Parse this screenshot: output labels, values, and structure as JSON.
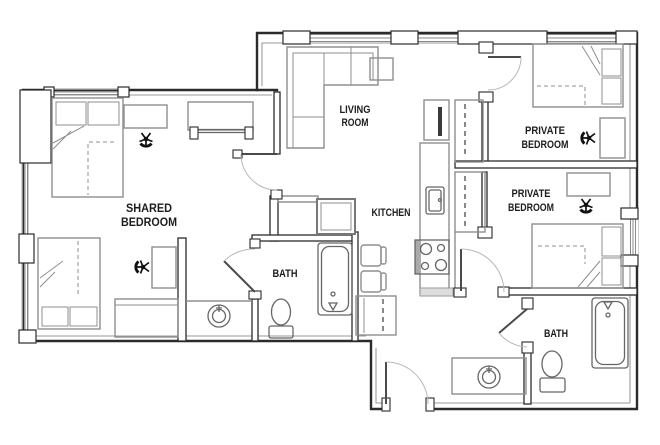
{
  "title": "Apartment floor plan",
  "colors": {
    "wall": "#2b2b2b",
    "furniture": "#8f8f8f",
    "fixture": "#666666",
    "label": "#1d1d1d",
    "background": "#ffffff"
  },
  "rooms": {
    "shared_bedroom": {
      "line1": "SHARED",
      "line2": "BEDROOM"
    },
    "living_room": {
      "line1": "LIVING",
      "line2": "ROOM"
    },
    "kitchen": {
      "label": "KITCHEN"
    },
    "bath_1": {
      "label": "BATH"
    },
    "private_bedroom_1": {
      "line1": "PRIVATE",
      "line2": "BEDROOM"
    },
    "private_bedroom_2": {
      "line1": "PRIVATE",
      "line2": "BEDROOM"
    },
    "bath_2": {
      "label": "BATH"
    }
  }
}
